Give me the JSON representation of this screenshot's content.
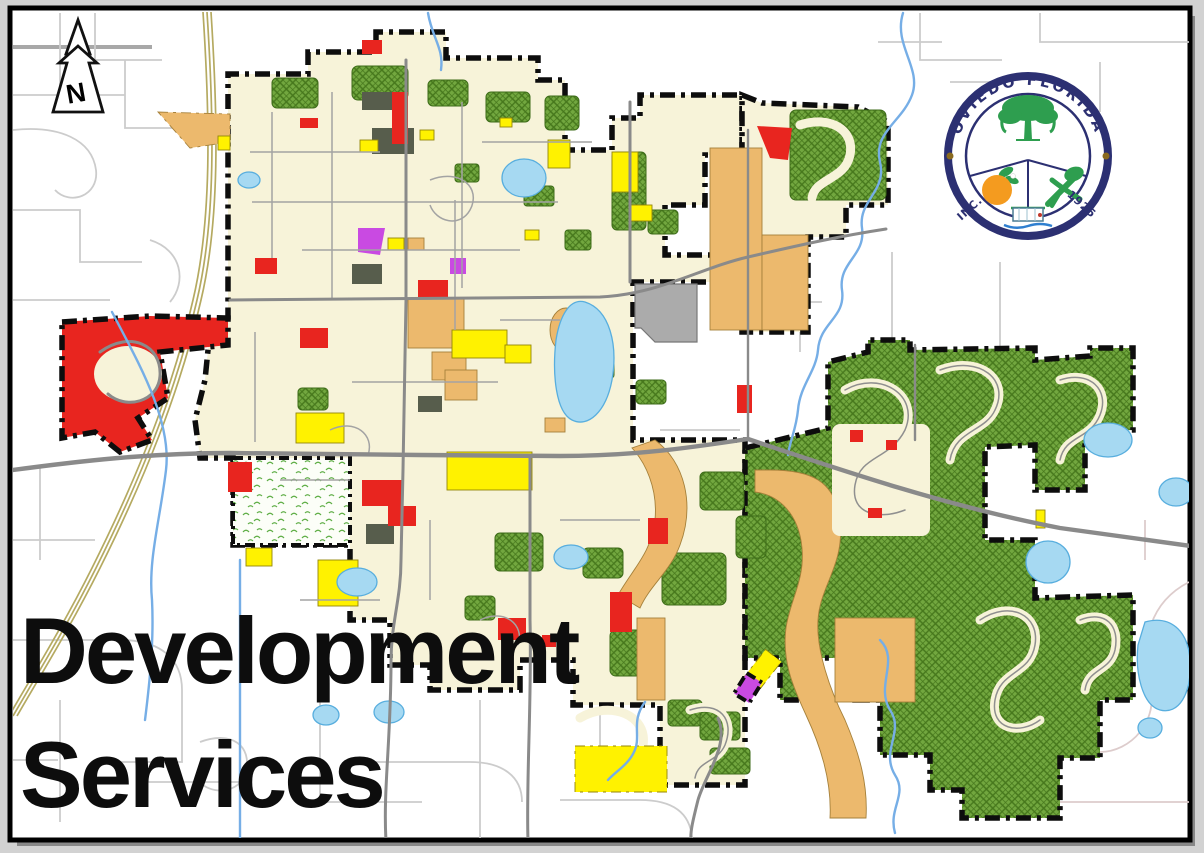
{
  "map": {
    "title": {
      "line1": "Development",
      "line2": "Services"
    },
    "compass": {
      "label": "N"
    },
    "seal": {
      "arc_text": "OVIEDO FLORIDA",
      "inc_text": "INC.",
      "year_text": "1925"
    },
    "palette": {
      "cream": "#f7f3d9",
      "hatch_green": "#72a73f",
      "hatch_line": "#46771c",
      "stipple_green": "#5fae46",
      "yellow": "#fff200",
      "red": "#e8251f",
      "tan": "#ecb96d",
      "purple": "#c94ae2",
      "county_gray": "#ababab",
      "dark_olive": "#575d4c",
      "lake_blue": "#a6d9f2",
      "lake_edge": "#58aede",
      "river_blue": "#76aee6",
      "road_gray": "#8a8a8a",
      "road_light": "#cccccc",
      "road_pink": "#ddcccc",
      "boundary": "#0d0d0d",
      "rail": "#b5aa61",
      "frame_bg": "#d2d2d2",
      "seal_navy": "#2c3072",
      "seal_green": "#2e9e4f",
      "seal_orange": "#f49b1f",
      "acorn_brown": "#8a6a1f",
      "title": "#0d0d0d"
    }
  }
}
